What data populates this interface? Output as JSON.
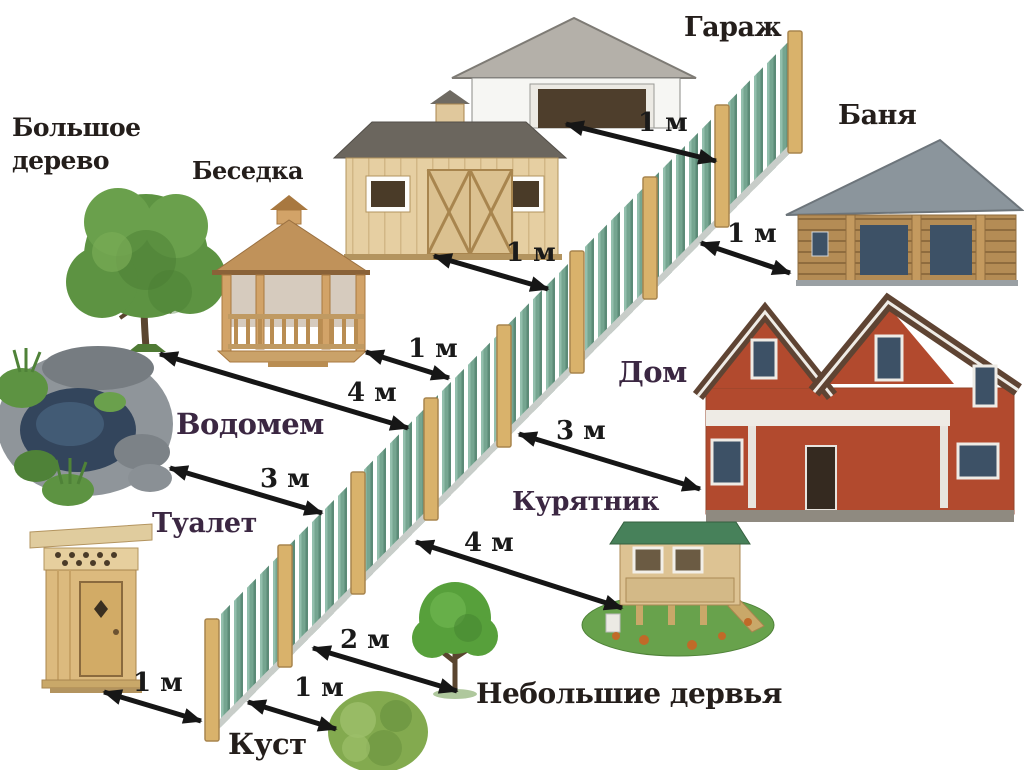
{
  "diagram": {
    "labels": {
      "garage": "Гараж",
      "banya": "Баня",
      "big_tree": "Большое дерево",
      "gazebo": "Беседка",
      "house": "Дом",
      "pond": "Водомем",
      "toilet": "Туалет",
      "chicken_coop": "Курятник",
      "small_trees": "Небольшие дервья",
      "bush": "Куст"
    },
    "distances": {
      "garage_to_fence": "1 м",
      "banya_to_fence": "1 м",
      "shed_to_fence": "1 м",
      "gazebo_to_fence": "1 м",
      "big_tree_to_fence": "4 м",
      "pond_to_fence": "3 м",
      "house_to_fence": "3 м",
      "chicken_coop_to_fence": "4 м",
      "toilet_to_fence": "1 м",
      "small_trees_to_fence": "2 м",
      "bush_to_fence": "1 м"
    },
    "colors": {
      "background": "#ffffff",
      "label_dark": "#241e1b",
      "label_plum": "#3b2742",
      "arrow": "#161616",
      "fence_picket_green": "#75a590",
      "fence_post_tan": "#d9b26b"
    }
  }
}
